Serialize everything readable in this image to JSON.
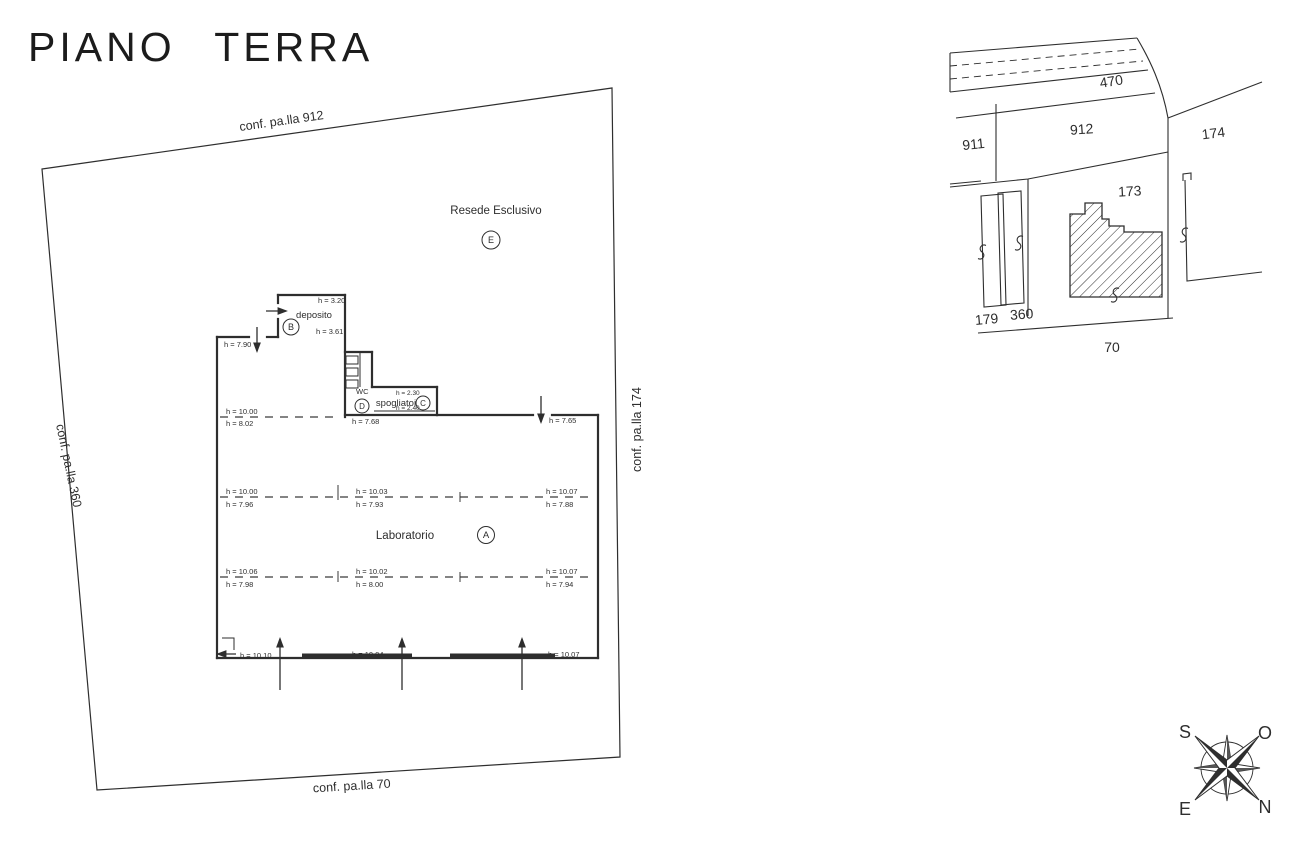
{
  "title": "PIANO TERRA",
  "boundaries": {
    "top": "conf. pa.lla 912",
    "left": "conf. pa.lla 360",
    "right": "conf. pa.lla 174",
    "bottom": "conf. pa.lla 70"
  },
  "areas": {
    "resede": {
      "label": "Resede Esclusivo",
      "tag": "E"
    },
    "laboratorio": {
      "label": "Laboratorio",
      "tag": "A"
    },
    "deposito": {
      "label": "deposito",
      "tag": "B"
    },
    "spogliatoi": {
      "label": "spogliatoi",
      "tag": "C"
    },
    "wc": {
      "label": "WC",
      "tag": "D"
    }
  },
  "heights": {
    "left_wall": "h = 7.90",
    "deposito_top": "h = 3.20",
    "deposito_bottom": "h = 3.61",
    "spogliatoi_top": "h = 2.30",
    "spogliatoi_bottom": "h = 2.40",
    "mid_left": "h = 7.68",
    "right_entry": "h = 7.65",
    "band1_left_top": "h = 10.00",
    "band1_left_bottom": "h = 8.02",
    "band2_left_top": "h = 10.00",
    "band2_left_bottom": "h = 7.96",
    "band2_mid_top": "h = 10.03",
    "band2_mid_bottom": "h = 7.93",
    "band2_right_top": "h = 10.07",
    "band2_right_bottom": "h = 7.88",
    "band3_left_top": "h = 10.06",
    "band3_left_bottom": "h = 7.98",
    "band3_mid_top": "h = 10.02",
    "band3_mid_bottom": "h = 8.00",
    "band3_right_top": "h = 10.07",
    "band3_right_bottom": "h = 7.94",
    "bottom_left": "h = 10.10",
    "bottom_mid": "h = 10.04",
    "bottom_right": "h = 10.07"
  },
  "cadastral": {
    "p470": "470",
    "p911": "911",
    "p912": "912",
    "p174": "174",
    "p173": "173",
    "p179": "179",
    "p360": "360",
    "p70": "70"
  },
  "compass": {
    "top_left": "S",
    "top_right": "O",
    "bottom_left": "E",
    "bottom_right": "N"
  },
  "colors": {
    "ink": "#2e2e2e",
    "paper": "#ffffff"
  }
}
